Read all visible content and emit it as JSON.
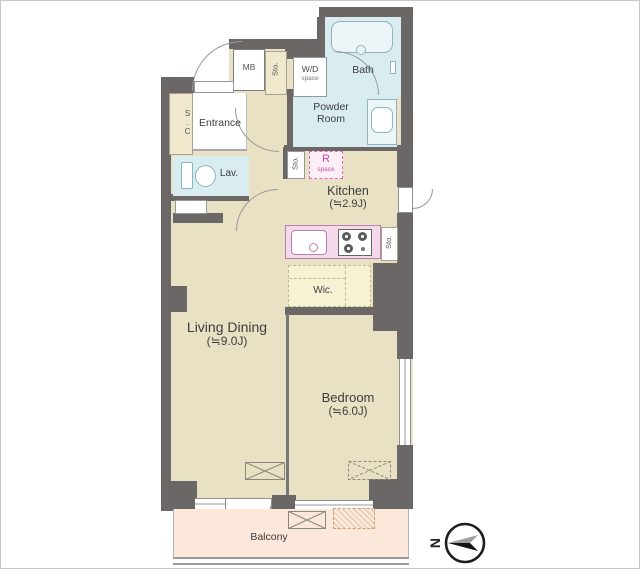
{
  "floorplan": {
    "rooms": {
      "living_dining": {
        "name": "Living Dining",
        "size": "(≒9.0J)"
      },
      "bedroom": {
        "name": "Bedroom",
        "size": "(≒6.0J)"
      },
      "kitchen": {
        "name": "Kitchen",
        "size": "(≒2.9J)"
      },
      "entrance": {
        "name": "Entrance"
      },
      "lavatory": {
        "name": "Lav."
      },
      "bath": {
        "name": "Bath"
      },
      "powder_room": {
        "line1": "Powder",
        "line2": "Room"
      },
      "wic": {
        "name": "Wic."
      },
      "balcony": {
        "name": "Balcony"
      }
    },
    "fixtures": {
      "meter_box": "MB",
      "shoe_closet": "S.C",
      "storage": "Sto.",
      "wd_space": {
        "line1": "W/D",
        "line2": "space"
      },
      "r_space": {
        "line1": "R",
        "line2": "space"
      }
    },
    "compass": {
      "north": "N"
    },
    "colors": {
      "wall": "#6b6767",
      "floor": "#e9e1c4",
      "wet_area": "#d9edf0",
      "kitchen_counter": "#f3d9ea",
      "closet": "#f8f2d4",
      "balcony": "#fce8da",
      "accent_pink": "#c94f9e"
    }
  }
}
